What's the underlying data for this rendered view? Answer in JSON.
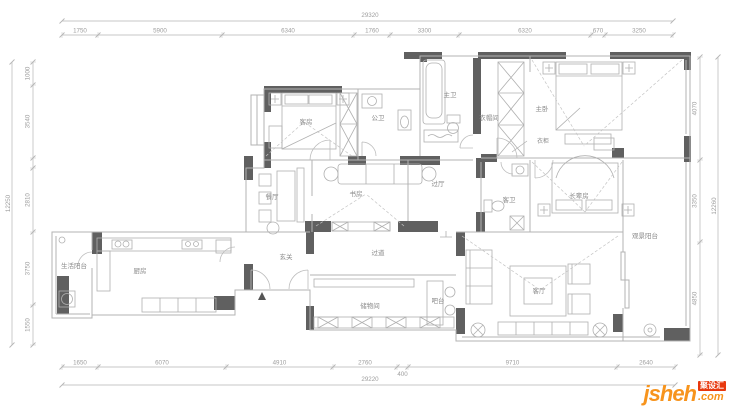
{
  "meta": {
    "background": "#ffffff",
    "wall_color": "#606060",
    "line_color": "#b3b3b3",
    "furniture_color": "#b0b0b0",
    "room_text_color": "#8a8a8a",
    "dim_color": "#b5b5b5",
    "dim_text_color": "#9e9e9e"
  },
  "rooms": [
    {
      "name": "客房",
      "x": 306,
      "y": 124
    },
    {
      "name": "公卫",
      "x": 378,
      "y": 120
    },
    {
      "name": "主卫",
      "x": 450,
      "y": 97
    },
    {
      "name": "衣帽间",
      "x": 489,
      "y": 120
    },
    {
      "name": "主卧",
      "x": 542,
      "y": 111
    },
    {
      "name": "餐厅",
      "x": 272,
      "y": 199
    },
    {
      "name": "书房",
      "x": 356,
      "y": 196
    },
    {
      "name": "过厅",
      "x": 438,
      "y": 186
    },
    {
      "name": "客卫",
      "x": 509,
      "y": 202
    },
    {
      "name": "长辈房",
      "x": 579,
      "y": 198
    },
    {
      "name": "观景阳台",
      "x": 645,
      "y": 238
    },
    {
      "name": "生活阳台",
      "x": 74,
      "y": 268
    },
    {
      "name": "厨房",
      "x": 140,
      "y": 273
    },
    {
      "name": "玄关",
      "x": 286,
      "y": 259
    },
    {
      "name": "过道",
      "x": 378,
      "y": 255
    },
    {
      "name": "储物间",
      "x": 370,
      "y": 308
    },
    {
      "name": "吧台",
      "x": 438,
      "y": 303
    },
    {
      "name": "客厅",
      "x": 539,
      "y": 293
    }
  ],
  "annotations": [
    {
      "text": "衣柜",
      "x": 543,
      "y": 143,
      "leader": [
        512,
        152,
        527,
        141
      ]
    }
  ],
  "dimensions": {
    "top_total": {
      "label": "29320",
      "x1": 62,
      "x2": 673,
      "y": 21,
      "lx": 370,
      "ly": 17
    },
    "top_row": {
      "y": 35,
      "ticks": [
        62,
        98,
        222,
        354,
        390,
        459,
        591,
        605,
        673
      ],
      "labels": [
        "1750",
        "5900",
        "6340",
        "1760",
        "3300",
        "6320",
        "670",
        "3250"
      ]
    },
    "bottom_row": {
      "y": 367,
      "ticks": [
        62,
        98,
        226,
        333,
        397,
        408,
        617,
        675
      ],
      "labels": [
        "1650",
        "6070",
        "4910",
        "2760",
        "400",
        "9710",
        "2640"
      ],
      "drop_labels": [
        4
      ]
    },
    "bottom_total": {
      "label": "29220",
      "x1": 62,
      "x2": 675,
      "y": 385,
      "lx": 370,
      "ly": 381
    },
    "left_col": {
      "x": 33,
      "ticks": [
        62,
        85,
        158,
        168,
        232,
        305,
        345
      ],
      "labels": [
        "1000",
        "3540",
        "",
        "2810",
        "3750",
        "1550"
      ]
    },
    "left_total": {
      "label": "12250",
      "x": 12,
      "y1": 62,
      "y2": 345
    },
    "right_col": {
      "x": 700,
      "ticks": [
        57,
        160,
        242,
        355
      ],
      "labels": [
        "4070",
        "3350",
        "4850"
      ]
    },
    "right_total": {
      "label": "12260",
      "x": 718,
      "y1": 57,
      "y2": 355
    }
  },
  "watermark": {
    "brand": "jsheh",
    "tld": ".com",
    "badge": "聚设汇",
    "brand_color": "#f7941d",
    "tld_color": "#f7941d",
    "badge_color": "#e8380d",
    "badge_text_color": "#ffffff"
  }
}
